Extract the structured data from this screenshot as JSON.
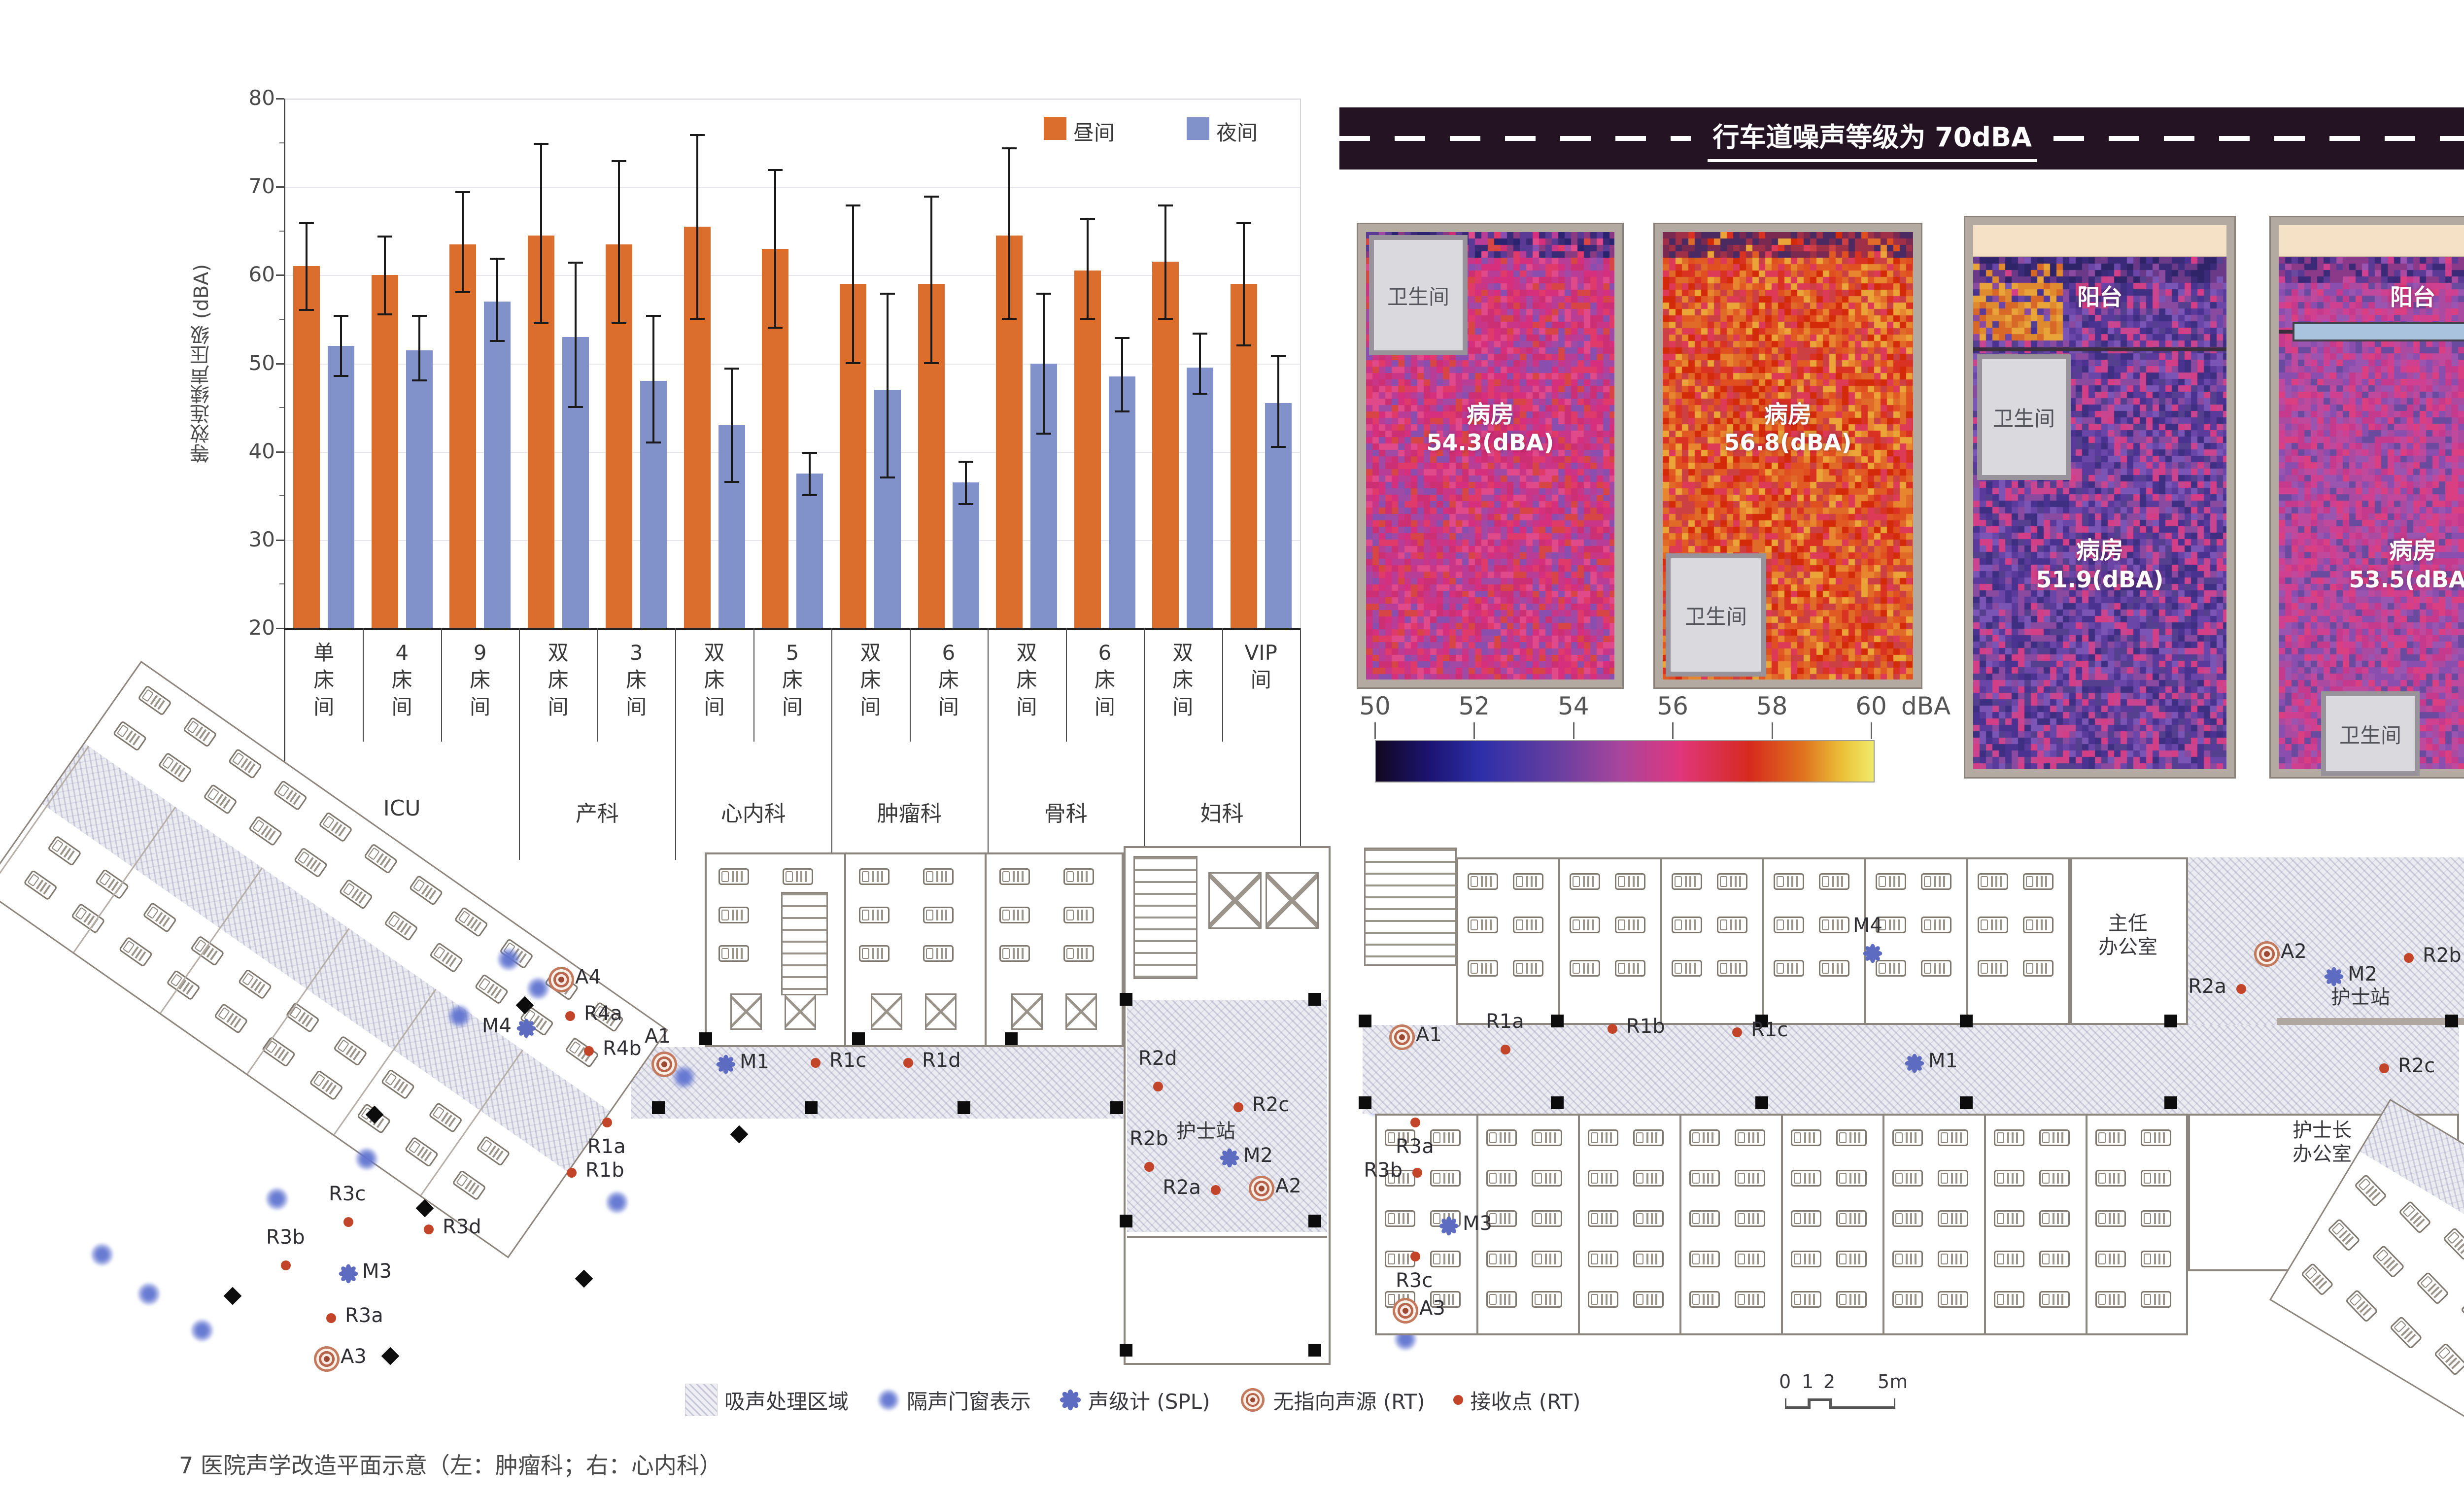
{
  "figure": {
    "caption": "7  医院声学改造平面示意（左：肿瘤科；右：心内科）"
  },
  "chart_data": {
    "type": "bar",
    "title": "",
    "ylabel": "等效连续声压级 (dBA)",
    "ylim": [
      20,
      80
    ],
    "yticks": [
      20,
      30,
      40,
      50,
      60,
      70,
      80
    ],
    "grid": true,
    "legend_position": "top-right",
    "categories": [
      "单床间",
      "4床间",
      "9床间",
      "双床间",
      "3床间",
      "双床间",
      "5床间",
      "双床间",
      "6床间",
      "双床间",
      "6床间",
      "双床间",
      "VIP间"
    ],
    "groups": [
      {
        "label": "ICU",
        "span": 3
      },
      {
        "label": "产科",
        "span": 2
      },
      {
        "label": "心内科",
        "span": 2
      },
      {
        "label": "肿瘤科",
        "span": 2
      },
      {
        "label": "骨科",
        "span": 2
      },
      {
        "label": "妇科",
        "span": 2
      }
    ],
    "series": [
      {
        "name": "昼间",
        "color": "#dc6e2d",
        "values": [
          61,
          60,
          63.5,
          64.5,
          63.5,
          65.5,
          63,
          59,
          59,
          64.5,
          60.5,
          61.5,
          59
        ],
        "err_low": [
          56,
          55.5,
          58,
          54.5,
          54.5,
          55,
          54,
          50,
          50,
          55,
          55,
          55,
          52
        ],
        "err_high": [
          66,
          64.5,
          69.5,
          75,
          73,
          76,
          72,
          68,
          69,
          74.5,
          66.5,
          68,
          66
        ]
      },
      {
        "name": "夜间",
        "color": "#8191ca",
        "values": [
          52,
          51.5,
          57,
          53,
          48,
          43,
          37.5,
          47,
          36.5,
          50,
          48.5,
          49.5,
          45.5
        ],
        "err_low": [
          48.5,
          48,
          52.5,
          45,
          41,
          36.5,
          35,
          37,
          34,
          42,
          44.5,
          46.5,
          40.5
        ],
        "err_high": [
          55.5,
          55.5,
          62,
          61.5,
          55.5,
          49.5,
          40,
          58,
          39,
          58,
          53,
          53.5,
          51
        ]
      }
    ]
  },
  "heatmap_panel": {
    "road_label": "行车道噪声等级为 70dBA",
    "rooms": [
      {
        "name": "病房",
        "value": "54.3(dBA)",
        "bathroom": "卫生间",
        "balcony": null
      },
      {
        "name": "病房",
        "value": "56.8(dBA)",
        "bathroom": "卫生间",
        "balcony": null
      },
      {
        "name": "病房",
        "value": "51.9(dBA)",
        "bathroom": "卫生间",
        "balcony": "阳台"
      },
      {
        "name": "病房",
        "value": "53.5(dBA)",
        "bathroom": "卫生间",
        "balcony": "阳台"
      }
    ],
    "colorbar": {
      "ticks": [
        "50",
        "52",
        "54",
        "56",
        "58",
        "60"
      ],
      "unit": "dBA"
    },
    "heatmap_colors": {
      "room1_base": [
        "#d62f7d",
        "#e03a6a",
        "#c93587",
        "#b83d96",
        "#a04aa6",
        "#d84545",
        "#cc2f74",
        "#8a4fae",
        "#e04a8a"
      ],
      "room1_top": [
        "#3a2a78",
        "#2a2370",
        "#5a3a95",
        "#8a3a80"
      ],
      "room2_base": [
        "#d93122",
        "#e04f20",
        "#e06a28",
        "#d32a0a",
        "#e8862f",
        "#eaa437",
        "#cc4044",
        "#dd3a57",
        "#e25a23"
      ],
      "room2_top": [
        "#7a2a50",
        "#4a2a60",
        "#a03048"
      ],
      "room3_base": [
        "#5a3a9a",
        "#4a3390",
        "#6a46a8",
        "#3f2f82",
        "#8a4aa0",
        "#c94590",
        "#d23f86",
        "#55408f",
        "#7a55b5"
      ],
      "room3_top": [
        "#2f2468",
        "#3a2a78",
        "#6a3a88"
      ],
      "room3_hot": [
        "#e08a30",
        "#e8a438",
        "#d86828"
      ],
      "room4_base": [
        "#cf4190",
        "#bf4a9d",
        "#8a4fae",
        "#aa4aa0",
        "#da3f82",
        "#6a4a9f",
        "#c53a8c",
        "#9a55b0"
      ],
      "room4_top": [
        "#3a2a78",
        "#5a3a95",
        "#8a3a88"
      ]
    }
  },
  "floorplans": {
    "left": {
      "labels": [
        {
          "text": "护士站",
          "x": 2447,
          "y": 2272
        }
      ],
      "points": [
        {
          "label": "A4",
          "type": "source",
          "x": 1139,
          "y": 1988,
          "side": "right"
        },
        {
          "label": "R4a",
          "type": "receiver",
          "x": 1157,
          "y": 2062,
          "side": "right"
        },
        {
          "label": "M4",
          "type": "meter",
          "x": 1068,
          "y": 2087,
          "side": "left"
        },
        {
          "label": "R4b",
          "type": "receiver",
          "x": 1195,
          "y": 2133,
          "side": "right"
        },
        {
          "label": "A1",
          "type": "source",
          "x": 1348,
          "y": 2160,
          "side": "top"
        },
        {
          "label": "M1",
          "type": "meter",
          "x": 1473,
          "y": 2160,
          "side": "right"
        },
        {
          "label": "R1c",
          "type": "receiver",
          "x": 1655,
          "y": 2157,
          "side": "right"
        },
        {
          "label": "R1d",
          "type": "receiver",
          "x": 1843,
          "y": 2157,
          "side": "right"
        },
        {
          "label": "R1a",
          "type": "receiver",
          "x": 1232,
          "y": 2278,
          "side": "bottom"
        },
        {
          "label": "R1b",
          "type": "receiver",
          "x": 1160,
          "y": 2380,
          "side": "right"
        },
        {
          "label": "R3c",
          "type": "receiver",
          "x": 707,
          "y": 2480,
          "side": "top"
        },
        {
          "label": "R3d",
          "type": "receiver",
          "x": 870,
          "y": 2495,
          "side": "right"
        },
        {
          "label": "R3b",
          "type": "receiver",
          "x": 580,
          "y": 2568,
          "side": "top"
        },
        {
          "label": "M3",
          "type": "meter",
          "x": 707,
          "y": 2585,
          "side": "right"
        },
        {
          "label": "R3a",
          "type": "receiver",
          "x": 672,
          "y": 2675,
          "side": "right"
        },
        {
          "label": "A3",
          "type": "source",
          "x": 663,
          "y": 2758,
          "side": "right"
        },
        {
          "label": "R2d",
          "type": "receiver",
          "x": 2350,
          "y": 2205,
          "side": "top"
        },
        {
          "label": "R2c",
          "type": "receiver",
          "x": 2513,
          "y": 2247,
          "side": "right"
        },
        {
          "label": "R2b",
          "type": "receiver",
          "x": 2332,
          "y": 2368,
          "side": "top"
        },
        {
          "label": "M2",
          "type": "meter",
          "x": 2495,
          "y": 2350,
          "side": "right"
        },
        {
          "label": "R2a",
          "type": "receiver",
          "x": 2467,
          "y": 2415,
          "side": "left"
        },
        {
          "label": "A2",
          "type": "source",
          "x": 2560,
          "y": 2412,
          "side": "right"
        }
      ]
    },
    "right": {
      "labels": [
        {
          "text": "主任\n办公室",
          "x": 4318,
          "y": 1850
        },
        {
          "text": "护士站",
          "x": 4790,
          "y": 2000
        },
        {
          "text": "护士长\n办公室",
          "x": 4712,
          "y": 2270
        }
      ],
      "points": [
        {
          "label": "A1",
          "type": "source",
          "x": 2845,
          "y": 2105,
          "side": "right"
        },
        {
          "label": "R1a",
          "type": "receiver",
          "x": 3055,
          "y": 2130,
          "side": "top"
        },
        {
          "label": "R1b",
          "type": "receiver",
          "x": 3272,
          "y": 2088,
          "side": "right"
        },
        {
          "label": "R1c",
          "type": "receiver",
          "x": 3525,
          "y": 2095,
          "side": "right"
        },
        {
          "label": "M4",
          "type": "meter",
          "x": 3800,
          "y": 1935,
          "side": "top"
        },
        {
          "label": "M1",
          "type": "meter",
          "x": 3885,
          "y": 2158,
          "side": "right"
        },
        {
          "label": "R2c",
          "type": "receiver",
          "x": 4838,
          "y": 2168,
          "side": "right"
        },
        {
          "label": "A2",
          "type": "source",
          "x": 4600,
          "y": 1936,
          "side": "right"
        },
        {
          "label": "R2a",
          "type": "receiver",
          "x": 4548,
          "y": 2007,
          "side": "left"
        },
        {
          "label": "M2",
          "type": "meter",
          "x": 4736,
          "y": 1982,
          "side": "right"
        },
        {
          "label": "R2b",
          "type": "receiver",
          "x": 4888,
          "y": 1944,
          "side": "right"
        },
        {
          "label": "R3a",
          "type": "receiver",
          "x": 2872,
          "y": 2278,
          "side": "bottom"
        },
        {
          "label": "R3b",
          "type": "receiver",
          "x": 2876,
          "y": 2380,
          "side": "left"
        },
        {
          "label": "M3",
          "type": "meter",
          "x": 2940,
          "y": 2488,
          "side": "right"
        },
        {
          "label": "R3c",
          "type": "receiver",
          "x": 2872,
          "y": 2550,
          "side": "bottom"
        },
        {
          "label": "A3",
          "type": "source",
          "x": 2852,
          "y": 2660,
          "side": "right"
        }
      ]
    }
  },
  "legend": {
    "items": [
      {
        "label": "吸声处理区域",
        "type": "hatch"
      },
      {
        "label": "隔声门窗表示",
        "type": "window"
      },
      {
        "label": "声级计 (SPL)",
        "type": "meter"
      },
      {
        "label": "无指向声源 (RT)",
        "type": "source"
      },
      {
        "label": "接收点 (RT)",
        "type": "receiver"
      }
    ],
    "scale": {
      "labels": [
        "0",
        "1",
        "2",
        "5m"
      ]
    }
  }
}
